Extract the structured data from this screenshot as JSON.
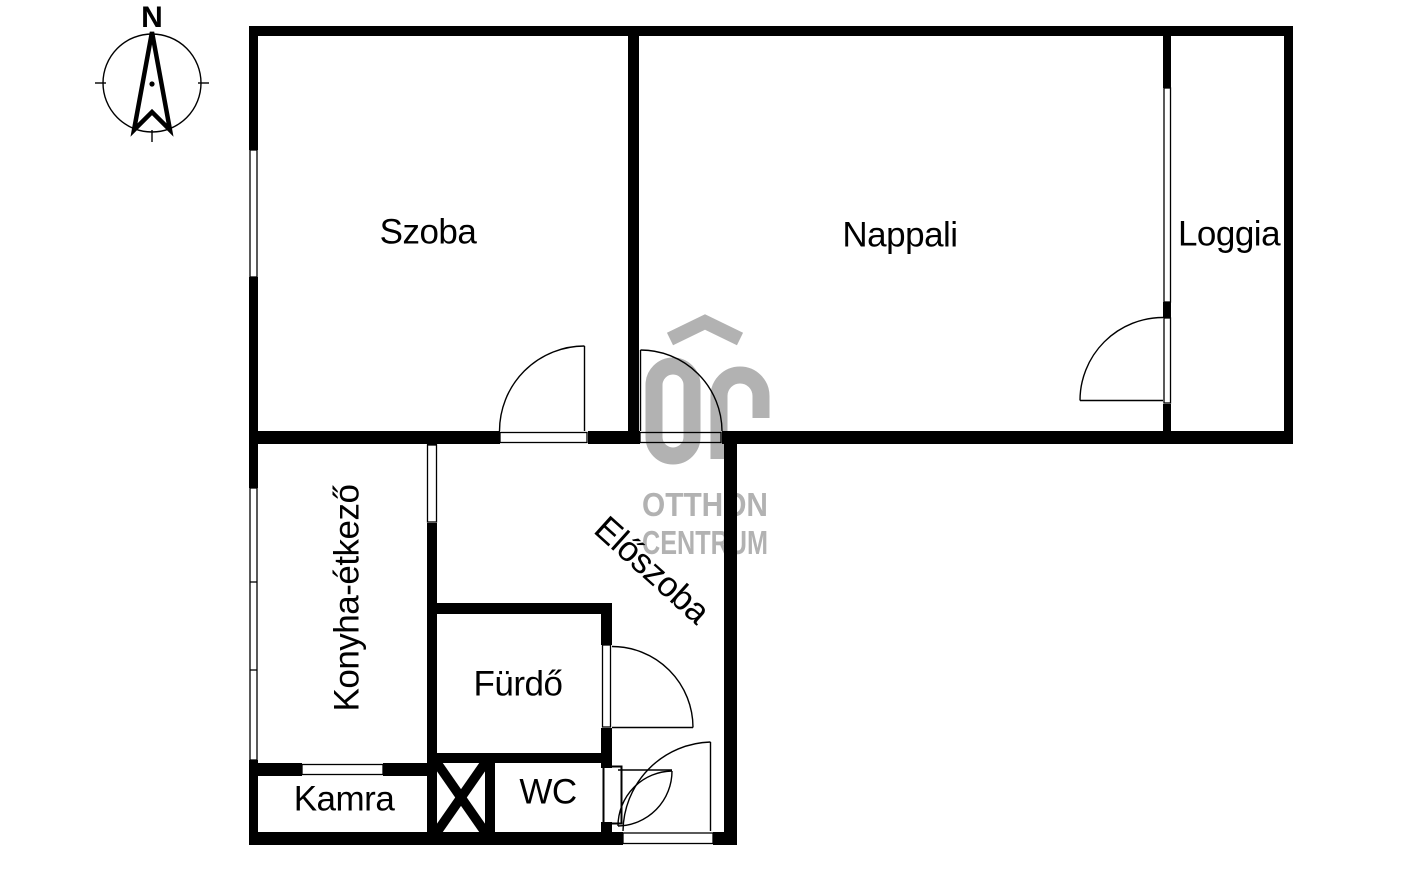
{
  "compass": {
    "north_label": "N"
  },
  "rooms": {
    "szoba": {
      "label": "Szoba"
    },
    "nappali": {
      "label": "Nappali"
    },
    "loggia": {
      "label": "Loggia"
    },
    "konyha": {
      "label": "Konyha-étkező"
    },
    "eloszoba": {
      "label": "Előszoba"
    },
    "furdo": {
      "label": "Fürdő"
    },
    "wc": {
      "label": "WC"
    },
    "kamra": {
      "label": "Kamra"
    }
  },
  "watermark": {
    "logo_monogram": "OC",
    "logo_icon": "house-roof-icon",
    "line1": "OTTHON",
    "line2": "CENTRUM"
  },
  "colors": {
    "walls": "#000000",
    "background": "#ffffff",
    "watermark_gray": "#b2b2b2",
    "label_text": "#000000"
  }
}
